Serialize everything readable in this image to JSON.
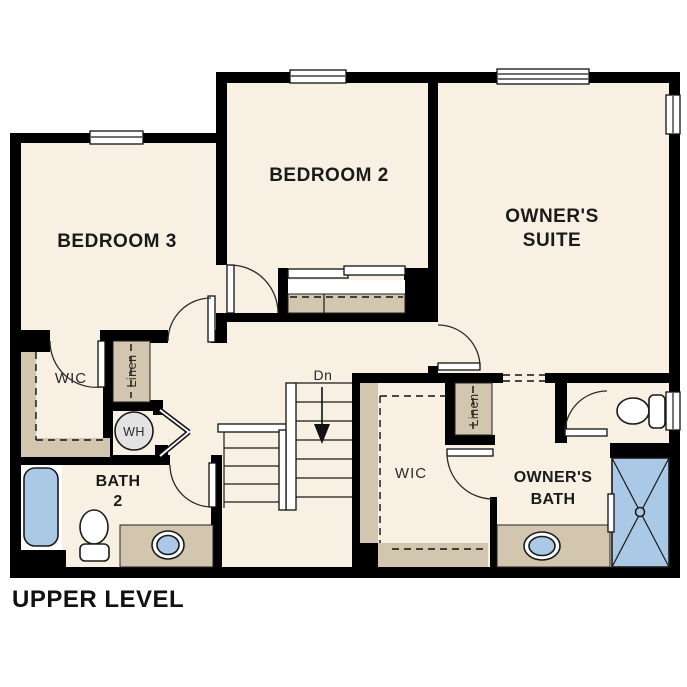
{
  "plan": {
    "title": "UPPER LEVEL",
    "labels": {
      "bedroom2": "BEDROOM 2",
      "bedroom3": "BEDROOM 3",
      "owners_suite": [
        "OWNER'S",
        "SUITE"
      ],
      "owners_bath": [
        "OWNER'S",
        "BATH"
      ],
      "bath2": [
        "BATH",
        "2"
      ],
      "wic_left": "WIC",
      "wic_right": "WIC",
      "linen_left": "Linen",
      "linen_right": "Linen",
      "water_heater": "WH",
      "stair_direction": "Dn"
    },
    "colors": {
      "background": "#ffffff",
      "wall": "#000000",
      "floor": "#f8f0e3",
      "casework": "#d3c6ae",
      "water_fixture": "#a9c9e6",
      "appliance": "#e3e3e3",
      "text": "#1a1a1a"
    }
  }
}
